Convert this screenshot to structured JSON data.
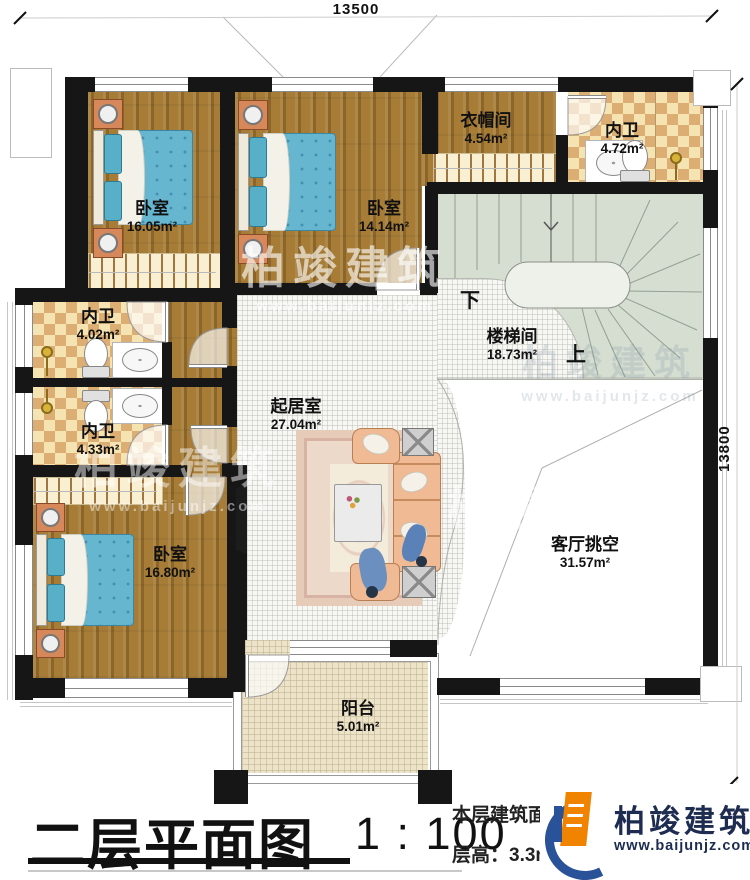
{
  "plan": {
    "dimensions": {
      "width_label": "13500",
      "height_label": "13800"
    },
    "rooms": {
      "bedroom_top_left": {
        "name": "卧室",
        "area": "16.05m²"
      },
      "bedroom_top_mid": {
        "name": "卧室",
        "area": "14.14m²"
      },
      "cloakroom": {
        "name": "衣帽间",
        "area": "4.54m²"
      },
      "bath_top_right": {
        "name": "内卫",
        "area": "4.72m²"
      },
      "bath_mid_left": {
        "name": "内卫",
        "area": "4.02m²"
      },
      "bath_low_left": {
        "name": "内卫",
        "area": "4.33m²"
      },
      "living_room": {
        "name": "起居室",
        "area": "27.04m²"
      },
      "stair_hall": {
        "name": "楼梯间",
        "area": "18.73m²"
      },
      "void_over_living": {
        "name": "客厅挑空",
        "area": "31.57m²"
      },
      "bedroom_bottom_left": {
        "name": "卧室",
        "area": "16.80m²"
      },
      "balcony": {
        "name": "阳台",
        "area": "5.01m²"
      }
    },
    "stair": {
      "down_label": "下",
      "up_label": "上"
    }
  },
  "titleblock": {
    "plan_title": "二层平面图",
    "scale": "1 : 100",
    "area_note": "本层建筑面积：",
    "floor_height_note": "层高：3.3m"
  },
  "watermark": {
    "brand": "柏竣建筑",
    "url": "www.baijunjz.com"
  },
  "logo": {
    "brand": "柏竣建筑",
    "url": "www.baijunjz.com"
  }
}
